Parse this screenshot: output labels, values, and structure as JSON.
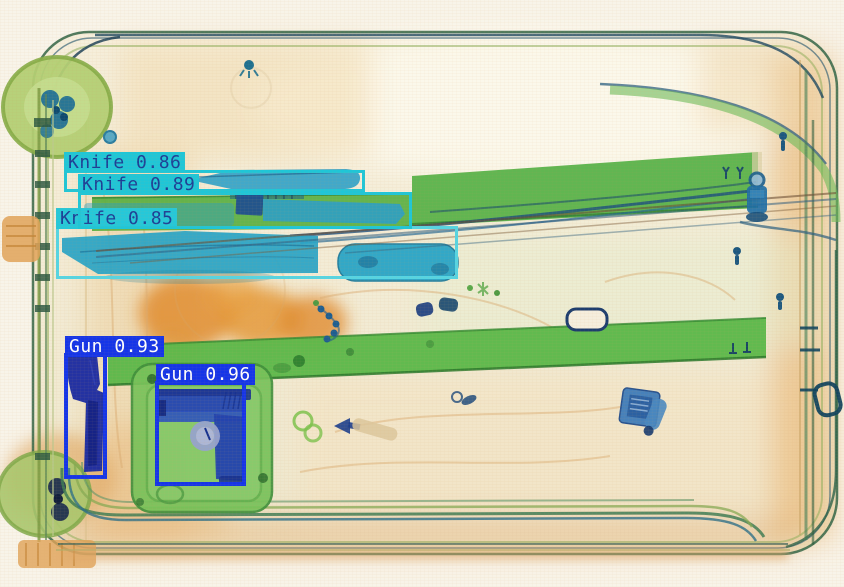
{
  "scene": {
    "kind": "xray-baggage-scan",
    "canvas": {
      "width": 844,
      "height": 587
    },
    "palette": {
      "background": "#f8f4e9",
      "organic_orange": "#e08c2e",
      "plastic_green": "#5cb84a",
      "metal_blue": "#2747b2",
      "knife_box_color": "#1fc6d7",
      "knife_box_light_color": "#55d5e3",
      "knife_text_color": "#1c3f96",
      "gun_box_color": "#1535e8",
      "gun_text_color": "#ffffff"
    }
  },
  "detections": [
    {
      "object": "Knife",
      "score": "0.86",
      "display": "Knife 0.86",
      "box": {
        "x": 64,
        "y": 170,
        "w": 301,
        "h": 22
      },
      "stroke": "#1fc6d7",
      "stroke_width": 3,
      "label_bg": "#1fc6d7",
      "label_fg": "#1c3f96"
    },
    {
      "object": "Knife",
      "score": "0.85",
      "display": "Knife 0.85",
      "box": {
        "x": 56,
        "y": 226,
        "w": 402,
        "h": 53
      },
      "stroke": "#55d5e3",
      "stroke_width": 3,
      "label_bg": "#25c8d9",
      "label_fg": "#1c3f96"
    },
    {
      "object": "Knife",
      "score": "0.89",
      "display": "Knife 0.89",
      "box": {
        "x": 78,
        "y": 192,
        "w": 334,
        "h": 37
      },
      "stroke": "#1fc6d7",
      "stroke_width": 3,
      "label_bg": "#1fc6d7",
      "label_fg": "#1c3f96"
    },
    {
      "object": "Gun",
      "score": "0.93",
      "display": "Gun 0.93",
      "box": {
        "x": 64,
        "y": 353,
        "w": 43,
        "h": 126
      },
      "stroke": "#1535e8",
      "stroke_width": 4,
      "label_bg": "#1535e8",
      "label_fg": "#ffffff"
    },
    {
      "object": "Gun",
      "score": "0.96",
      "display": "Gun 0.96",
      "box": {
        "x": 155,
        "y": 381,
        "w": 91,
        "h": 105
      },
      "stroke": "#1535e8",
      "stroke_width": 4,
      "label_bg": "#1535e8",
      "label_fg": "#ffffff"
    }
  ]
}
